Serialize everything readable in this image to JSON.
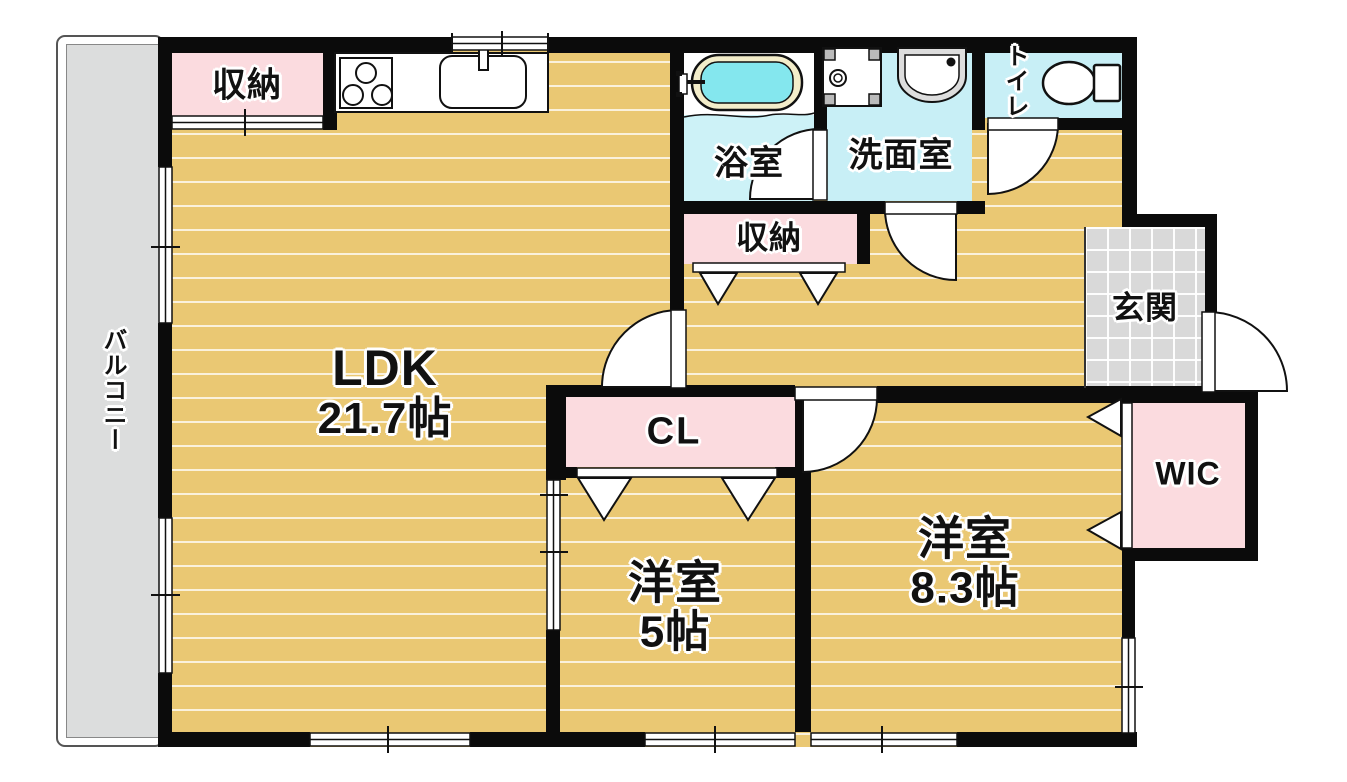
{
  "plan": {
    "type": "apartment-floor-plan",
    "rooms": {
      "ldk": {
        "name": "LDK",
        "size": "21.7帖"
      },
      "bedroom5": {
        "name": "洋室",
        "size": "5帖"
      },
      "bedroom83": {
        "name": "洋室",
        "size": "8.3帖"
      },
      "bath": {
        "name": "浴室"
      },
      "washroom": {
        "name": "洗面室"
      },
      "toilet": {
        "name": "トイレ"
      },
      "entrance": {
        "name": "玄関"
      },
      "balcony": {
        "name": "バルコニー"
      },
      "storage_kitchen": {
        "name": "収納"
      },
      "storage_hall": {
        "name": "収納"
      },
      "closet": {
        "name": "CL"
      },
      "walk_in_closet": {
        "name": "WIC"
      }
    },
    "colors": {
      "wall": "#0b0b0b",
      "flooring": "#eac873",
      "floor_stripe": "#ffffff",
      "closet_pink": "#fbdbdf",
      "wet_area_cyan": "#c8eff6",
      "bath_floor_cyan": "#cdf2f7",
      "tub_water": "#84e7ee",
      "tub_rim": "#f3edca",
      "balcony_gray": "#dcdddd",
      "entrance_tile_gray": "#d9d9d9"
    }
  }
}
